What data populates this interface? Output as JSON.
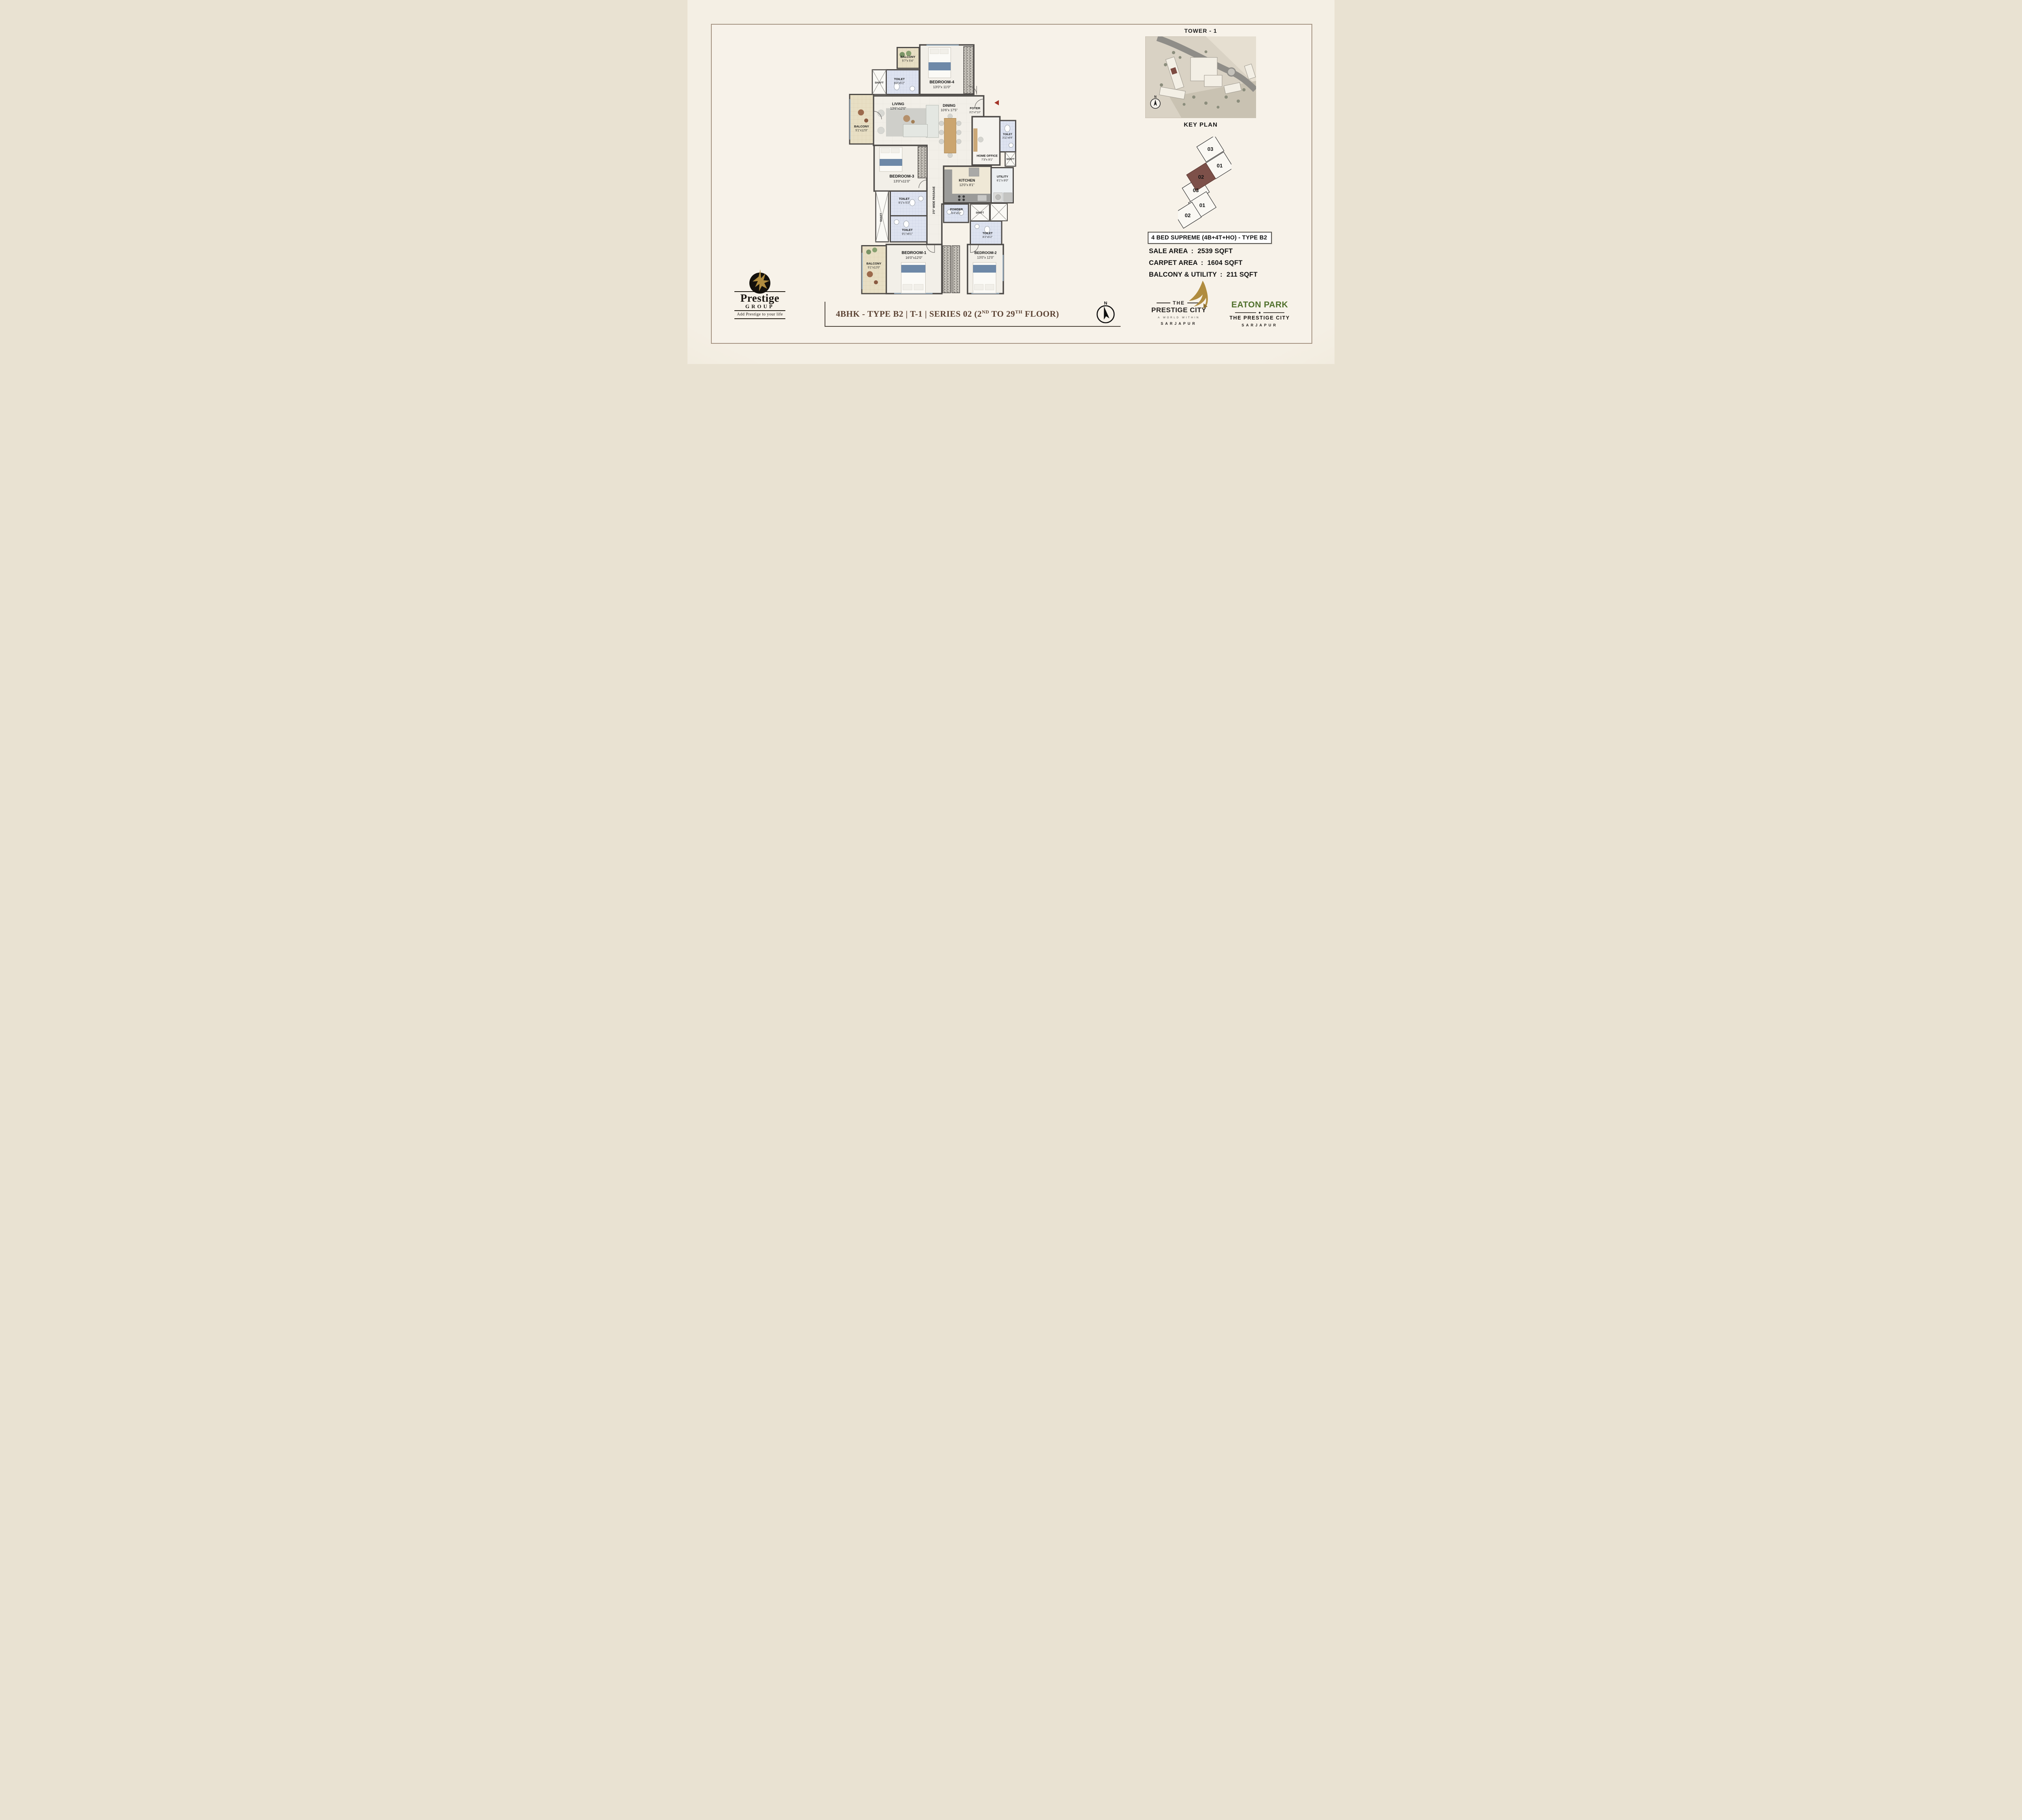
{
  "plan": {
    "shaft_label": "SHAFT",
    "passage_label": "3'5\" WIDE PASSAGE",
    "rooms": {
      "balcony_top": {
        "name": "BALCONY",
        "dims": "5'7\"x 5'4\""
      },
      "toilet_top": {
        "name": "TOILET",
        "dims": "8'2\"x5'2\""
      },
      "bedroom4": {
        "name": "BEDROOM-4",
        "dims": "13'0\"x 11'0\""
      },
      "living": {
        "name": "LIVING",
        "dims": "13'6\"x12'0\""
      },
      "dining": {
        "name": "DINING",
        "dims": "10'6\"x 17'5\""
      },
      "foyer": {
        "name": "FOYER",
        "dims": "3'2\"x7'10\""
      },
      "balcony_left": {
        "name": "BALCONY",
        "dims": "5'1\"x12'0\""
      },
      "bedroom3": {
        "name": "BEDROOM-3",
        "dims": "13'0\"x11'0\""
      },
      "home_office": {
        "name": "HOME OFFICE",
        "dims": "7'3\"x 9'1\""
      },
      "toilet_ho": {
        "name": "TOILET",
        "dims": "3'11\"x6'9\""
      },
      "kitchen": {
        "name": "KITCHEN",
        "dims": "12'0\"x 8'1\""
      },
      "utility": {
        "name": "UTILITY",
        "dims": "6'1\"x 8'0\""
      },
      "toilet_mid_upper": {
        "name": "TOILET",
        "dims": "9'1\"x 5'2\""
      },
      "toilet_mid_lower": {
        "name": "TOILET",
        "dims": "9'1\"x6'1\""
      },
      "powder": {
        "name": "POWDER",
        "dims": "6'4\"x5'2\""
      },
      "toilet_bed2": {
        "name": "TOILET",
        "dims": "8'2\"x5'2\""
      },
      "bedroom1": {
        "name": "BEDROOM-1",
        "dims": "16'0\"x12'0\""
      },
      "balcony_bottom": {
        "name": "BALCONY",
        "dims": "5'1\"x12'0\""
      },
      "bedroom2": {
        "name": "BEDROOM-2",
        "dims": "13'0\"x 12'0\""
      }
    }
  },
  "key_plan": {
    "tower_title": "TOWER - 1",
    "caption": "KEY PLAN",
    "compass_n": "N"
  },
  "unit_diagram": {
    "units": [
      "03",
      "01",
      "02",
      "03",
      "01",
      "02"
    ],
    "highlight_index": 2,
    "highlight_color": "#7d5049"
  },
  "specs": {
    "title": "4 BED SUPREME (4B+4T+HO) - TYPE B2",
    "rows": [
      {
        "label": "SALE AREA",
        "value": "2539 SQFT"
      },
      {
        "label": "CARPET AREA",
        "value": "1604 SQFT"
      },
      {
        "label": "BALCONY & UTILITY",
        "value": "211 SQFT"
      }
    ]
  },
  "footer": {
    "title_pre": "4BHK - TYPE B2 | T-1 | SERIES 02 (2",
    "title_sup1": "ND",
    "title_mid": " TO 29",
    "title_sup2": "TH",
    "title_post": " FLOOR)",
    "compass_n": "N",
    "accent_color": "#5b4233"
  },
  "logos": {
    "prestige_group": {
      "brand": "Prestige",
      "sub": "GROUP",
      "tagline": "Add Prestige to your life"
    },
    "prestige_city": {
      "the": "THE",
      "name": "PRESTIGE CITY",
      "tag": "A WORLD WITHIN",
      "place": "SARJAPUR"
    },
    "eaton_park": {
      "name": "EATON PARK",
      "sub": "THE PRESTIGE CITY",
      "place": "SARJAPUR",
      "accent": "#50702c"
    }
  }
}
